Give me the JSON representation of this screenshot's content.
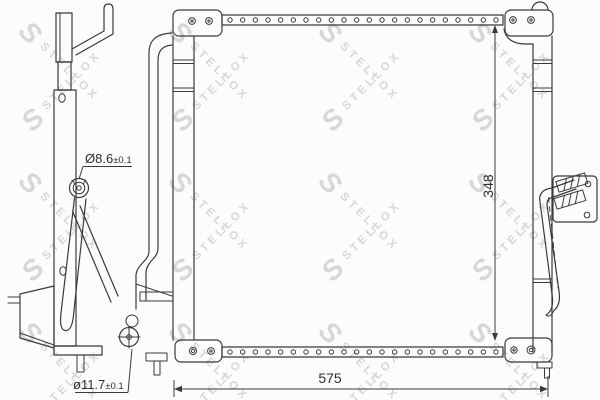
{
  "watermark": {
    "logo_letter": "S",
    "brand_text": "STELLOX",
    "color": "#d7d7d7"
  },
  "labels": {
    "width": "575",
    "height": "348",
    "port_top": {
      "diameter": "Ø8.6",
      "tolerance": "±0.1"
    },
    "port_bottom": {
      "diameter": "ø11.7",
      "tolerance": "±0.1"
    }
  },
  "colors": {
    "line": "#3a3a3a",
    "text": "#2e2e2e",
    "watermark": "#d7d7d7",
    "background": "#fcfcfb"
  }
}
